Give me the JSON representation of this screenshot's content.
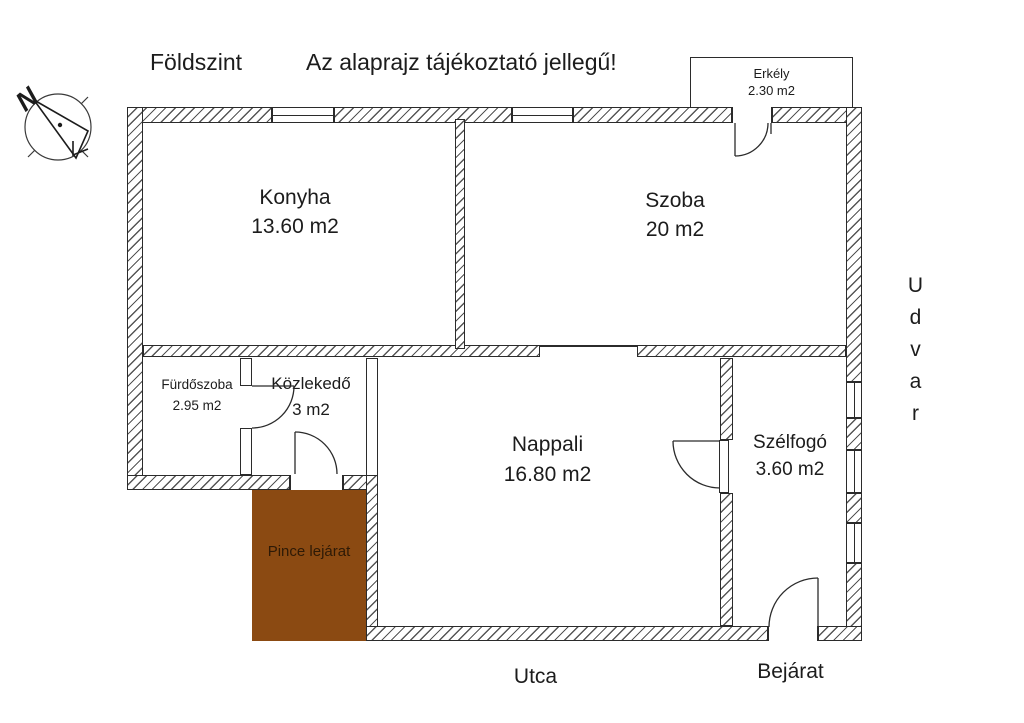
{
  "page": {
    "floor_label": "Földszint",
    "disclaimer": "Az alaprajz tájékoztató jellegű!"
  },
  "rooms": {
    "konyha": {
      "name": "Konyha",
      "area": "13.60 m2"
    },
    "szoba": {
      "name": "Szoba",
      "area": "20 m2"
    },
    "furdoszoba": {
      "name": "Fürdőszoba",
      "area": "2.95 m2"
    },
    "kozlekedo": {
      "name": "Közlekedő",
      "area": "3 m2"
    },
    "nappali": {
      "name": "Nappali",
      "area": "16.80 m2"
    },
    "szelfogo": {
      "name": "Szélfogó",
      "area": "3.60 m2"
    },
    "erkely": {
      "name": "Erkély",
      "area": "2.30 m2"
    },
    "pince": {
      "name": "Pince lejárat"
    }
  },
  "context": {
    "right_side": "Udvar",
    "street": "Utca",
    "entrance": "Bejárat"
  },
  "compass": {
    "north": "N"
  },
  "colors": {
    "pince_fill": "#8B4A12",
    "pince_text": "#2E1A06",
    "line": "#2B2B2B"
  }
}
